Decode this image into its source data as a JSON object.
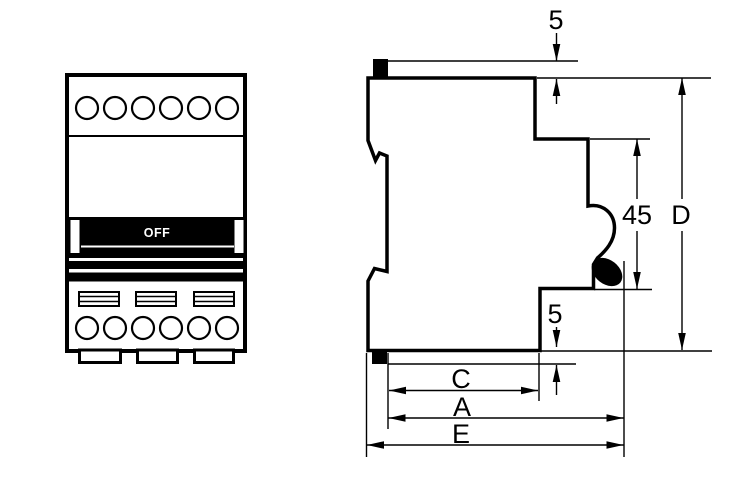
{
  "front_view": {
    "toggle_label": "OFF"
  },
  "side_view": {
    "dimensions": {
      "top_offset": "5",
      "recess_height": "45",
      "total_height": "D",
      "bottom_offset": "5",
      "base_width": "C",
      "body_width": "A",
      "total_width": "E"
    }
  },
  "colors": {
    "line": "#000000",
    "background": "#ffffff",
    "handle_fill": "#000000",
    "handle_label": "#ffffff"
  }
}
